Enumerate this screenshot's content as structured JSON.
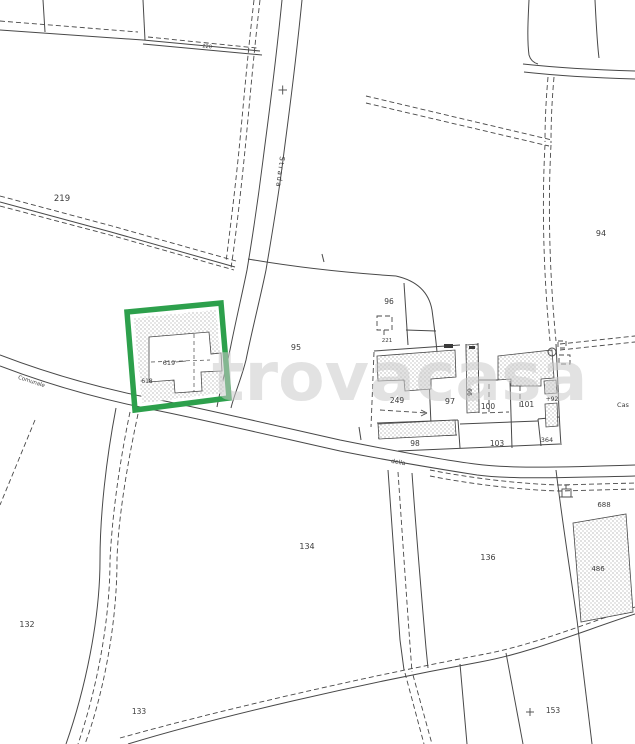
{
  "watermark": "trovacasa",
  "roads": {
    "strada_label": "Strada",
    "comunale_label": "Comunale",
    "della_label": "della"
  },
  "parcels": {
    "p219": "219",
    "p220": "220",
    "p94": "94",
    "p95": "95",
    "p96": "96",
    "p221": "221",
    "p249": "249",
    "p97": "97",
    "p99": "99",
    "p100": "100",
    "p101": "101",
    "p92": "+92",
    "p98": "98",
    "p103": "103",
    "p364": "364",
    "cas": "Cas",
    "p132": "132",
    "p133": "133",
    "p134": "134",
    "p136": "136",
    "p688": "688",
    "p486": "486",
    "p153": "153",
    "p619": "619",
    "p618": "618"
  },
  "colors": {
    "highlight_green": "#2da04c",
    "line": "#484848",
    "watermark_gray": "#cbcbcb",
    "background": "#ffffff"
  }
}
